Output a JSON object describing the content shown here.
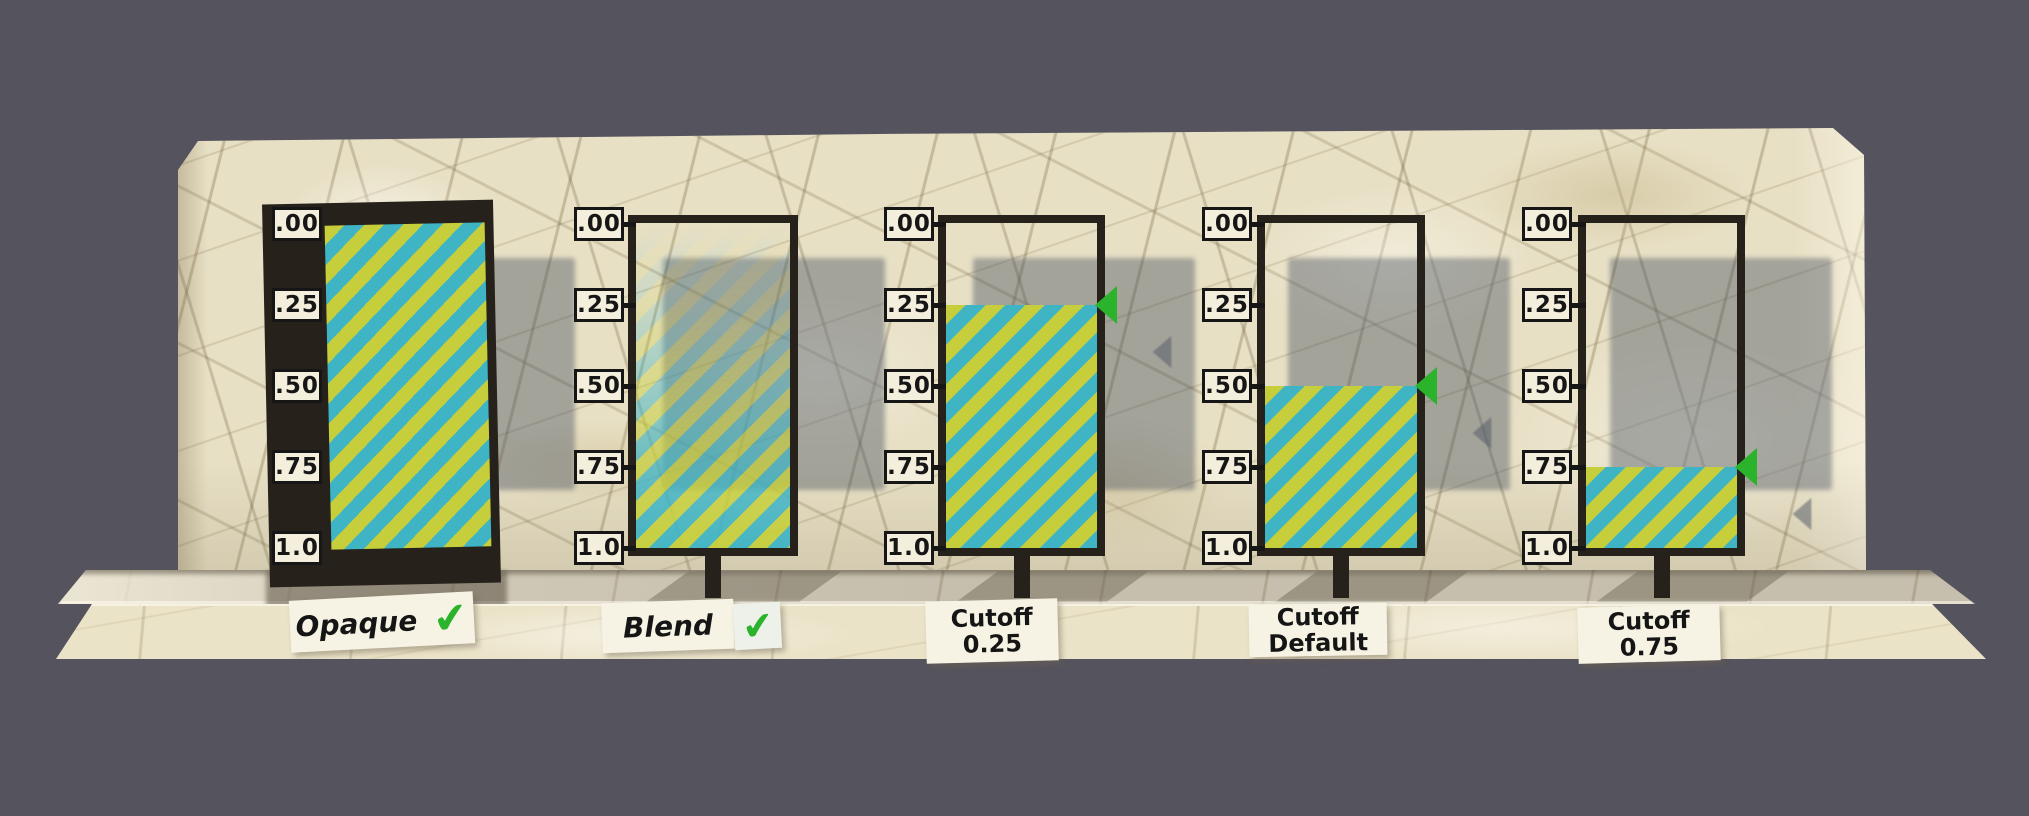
{
  "background_color": "#55535d",
  "colors": {
    "marble": "#e8e0c5",
    "marble_ledge": "#c6bfad",
    "marble_front": "#ebe3c8",
    "frame_black": "#26221b",
    "label_box_bg": "#f4efdc",
    "label_text": "#161616",
    "card_bg": "#f7f3e4",
    "stripe_yellow": "#c6cf3b",
    "stripe_cyan": "#3eb4c5",
    "accent_green": "#2cb32c",
    "shadow_gray": "rgba(70,78,96,0.42)"
  },
  "icons": {
    "checkmark": "✔",
    "cutoff_marker": "left-pointing-triangle"
  },
  "scale_labels": [
    ".00",
    ".25",
    ".50",
    ".75",
    "1.0"
  ],
  "panels": [
    {
      "name": "opaque",
      "mode": "opaque",
      "card_label": "Opaque",
      "has_checkmark": true
    },
    {
      "name": "blend",
      "mode": "blend",
      "card_label": "Blend",
      "has_checkmark": true
    },
    {
      "name": "cutoff-025",
      "mode": "cutoff",
      "cutoff": 0.25,
      "card_label": "Cutoff",
      "card_sublabel": "0.25"
    },
    {
      "name": "cutoff-default",
      "mode": "cutoff",
      "cutoff": 0.5,
      "card_label": "Cutoff",
      "card_sublabel": "Default"
    },
    {
      "name": "cutoff-075",
      "mode": "cutoff",
      "cutoff": 0.75,
      "card_label": "Cutoff",
      "card_sublabel": "0.75"
    }
  ]
}
